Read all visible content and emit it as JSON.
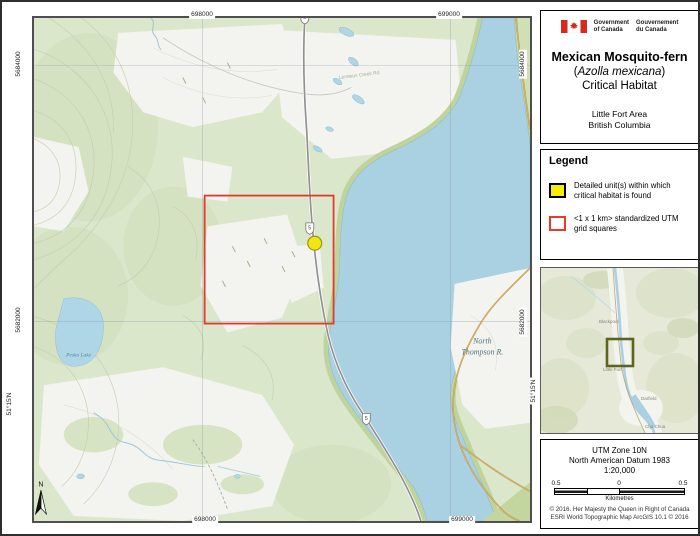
{
  "wordmark": {
    "gov_en_1": "Government",
    "gov_en_2": "of Canada",
    "gov_fr_1": "Gouvernement",
    "gov_fr_2": "du Canada"
  },
  "title_block": {
    "line1": "Mexican Mosquito-fern",
    "line2_open": "(",
    "line2_species": "Azolla mexicana",
    "line2_close": ")",
    "line3": "Critical Habitat",
    "area": "Little Fort Area",
    "province": "British Columbia"
  },
  "legend": {
    "heading": "Legend",
    "item1": "Detailed unit(s) within which critical habitat is found",
    "item2": "<1 x 1 km> standardized UTM grid squares"
  },
  "map": {
    "north_letter": "N",
    "highway_shield": "5",
    "grid": {
      "top": [
        "698000",
        "699000"
      ],
      "bottom": [
        "698000",
        "699000"
      ],
      "left": [
        "5684000",
        "5682000"
      ],
      "right": [
        "5684000",
        "5682000"
      ],
      "lat_left": "51°15'N",
      "lat_right": "51°15'N"
    },
    "labels": {
      "river_line1": "North",
      "river_line2": "Thompson R.",
      "lake": "Peska Lake",
      "road": "Lemieux Creek Rd"
    },
    "colors": {
      "forest_green": "#dbe7cb",
      "water_blue": "#a9d1e1",
      "grid_square_red": "#e0392d",
      "habitat_yellow": "#f4e416"
    }
  },
  "inset": {
    "labels": [
      "Blackpool",
      "Little Fort",
      "Darfield",
      "Chu Chua"
    ],
    "extent_color": "#5c641f"
  },
  "info": {
    "utm_zone": "UTM Zone 10N",
    "datum": "North American Datum 1983",
    "scale": "1:20,000",
    "scalebar": {
      "left": "0.5",
      "center": "0",
      "right": "0.5",
      "unit": "Kilometres"
    },
    "copyright_1": "© 2016. Her Majesty the Queen in Right of Canada",
    "copyright_2": "ESRI World Topographic Map ArcGIS 10.1 © 2016"
  }
}
